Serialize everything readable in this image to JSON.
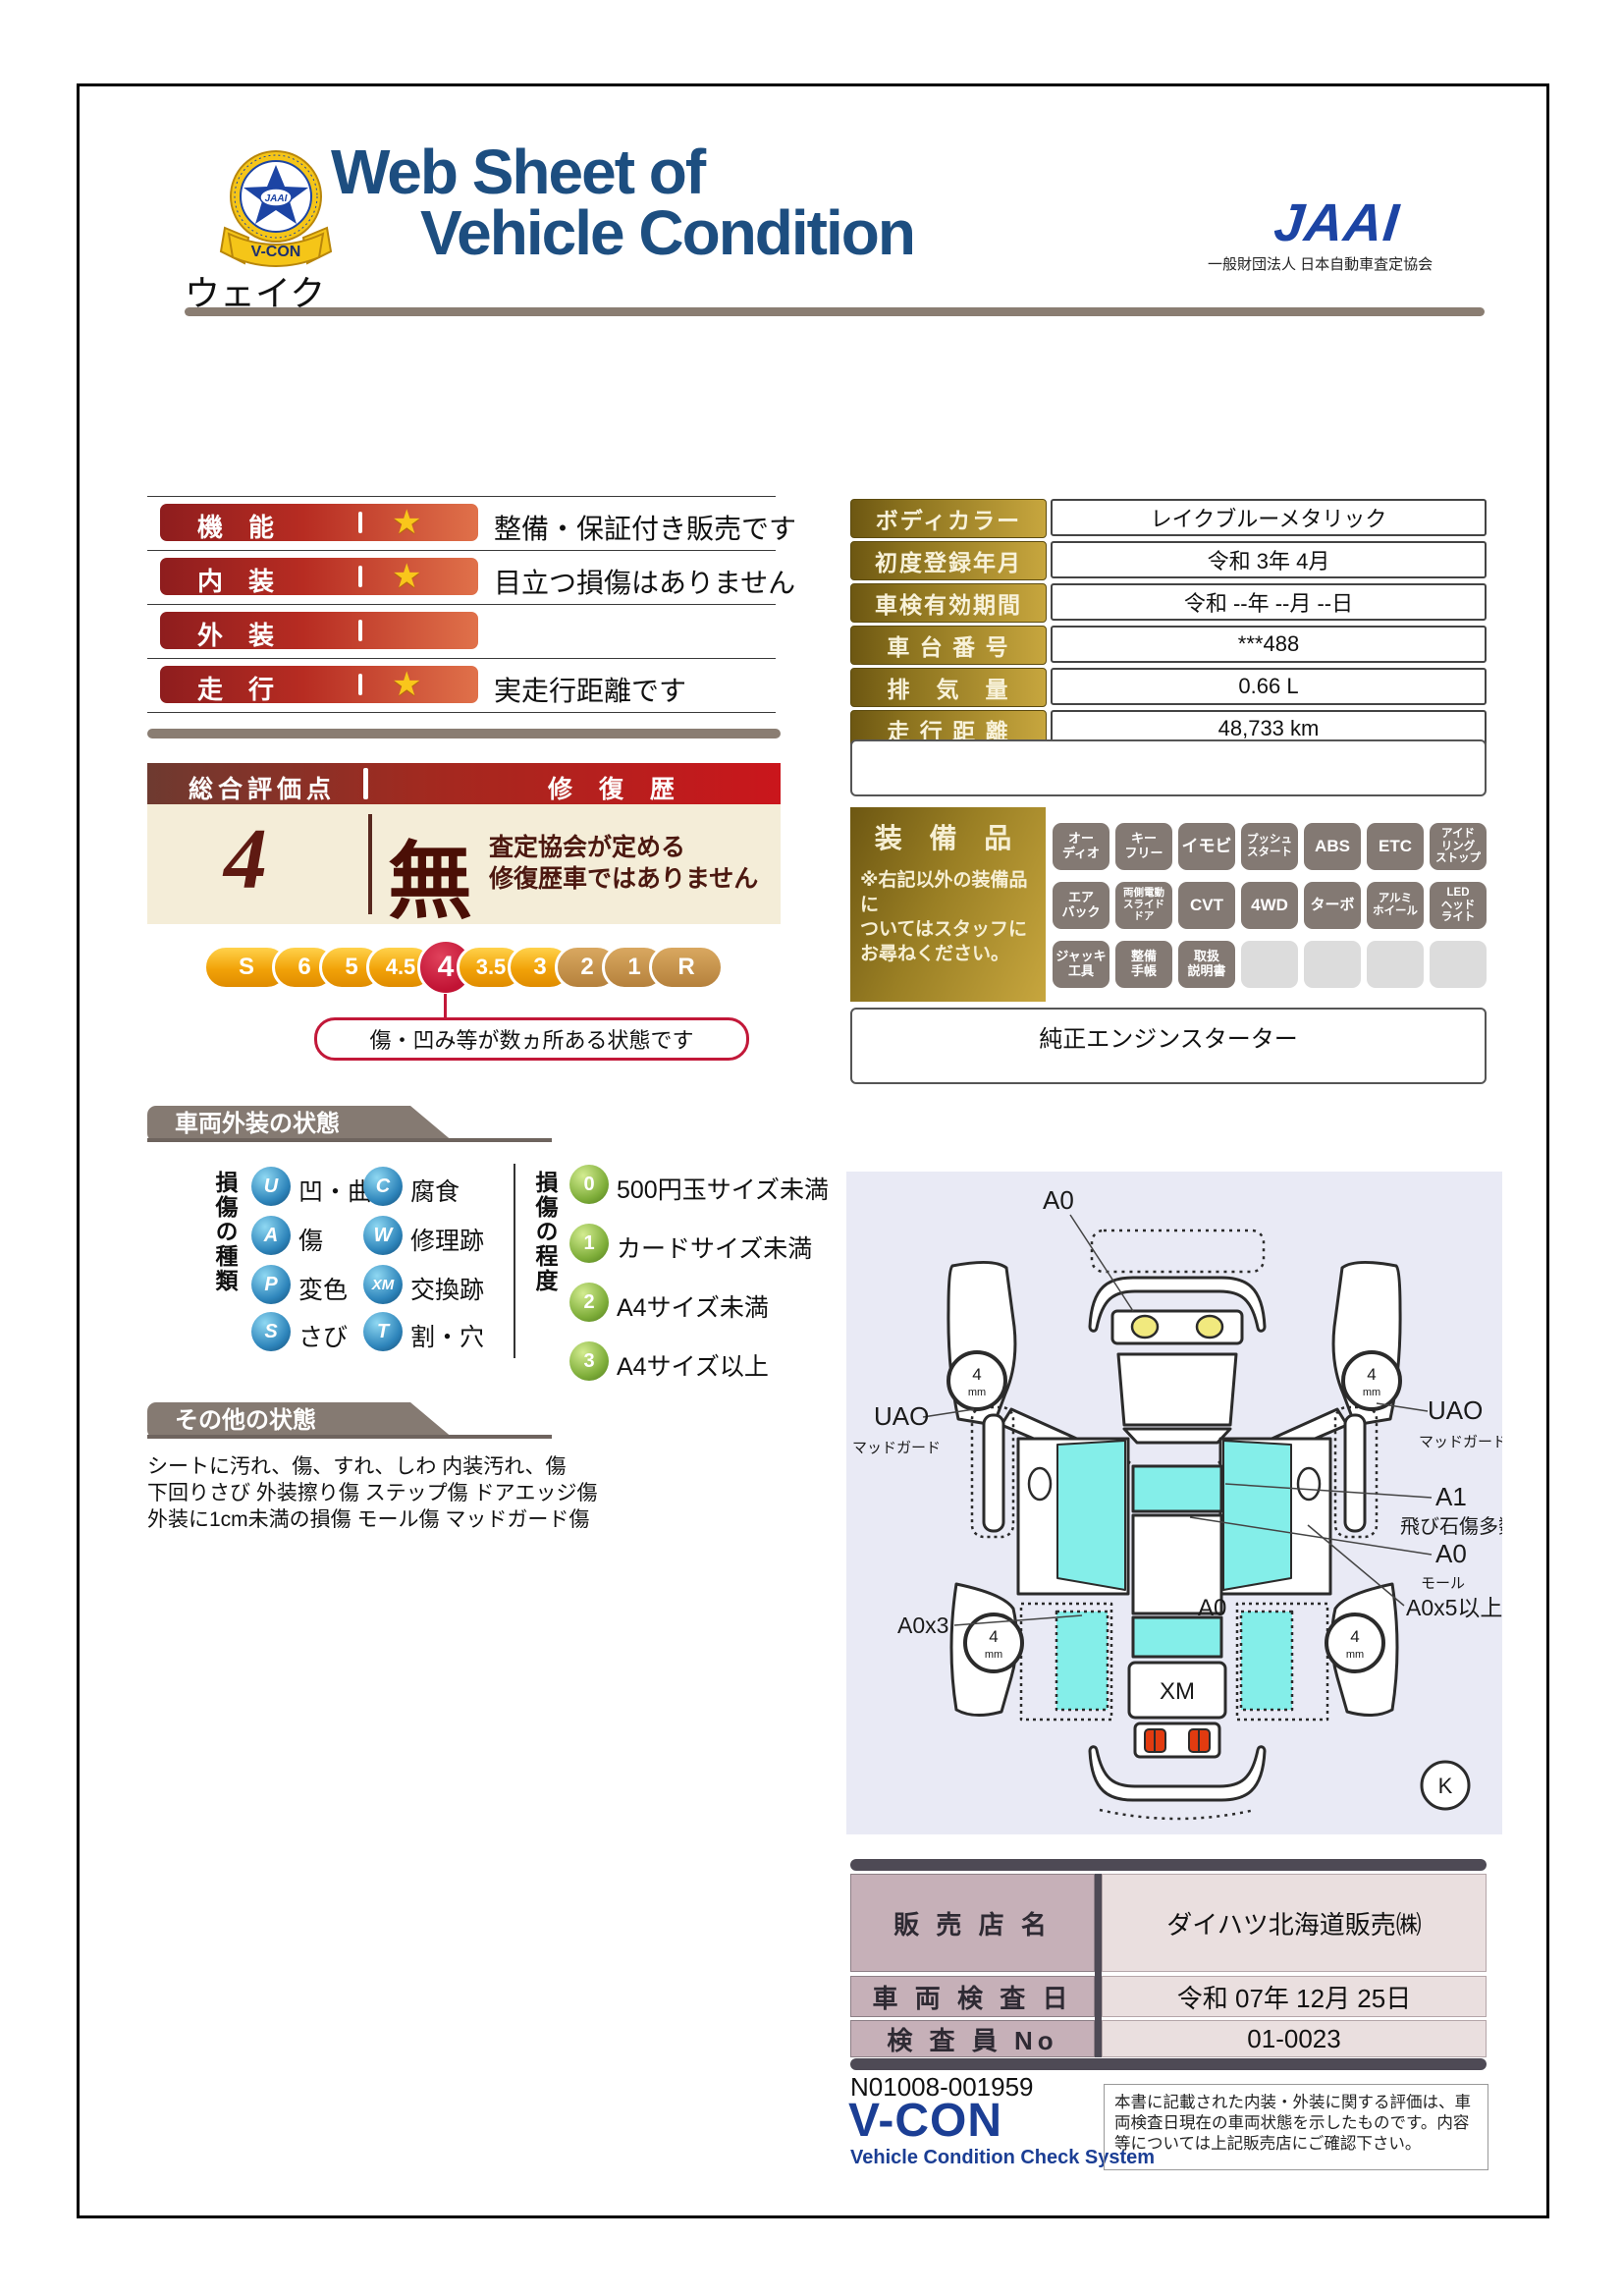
{
  "header": {
    "title_line1": "Web Sheet of",
    "title_line2": "Vehicle Condition",
    "badge_text": "V-CON",
    "badge_star_text": "JAAI",
    "jaai_logo": "JAAI",
    "jaai_subtitle": "一般財団法人 日本自動車査定協会"
  },
  "vehicle_name": "ウェイク",
  "ratings": [
    {
      "label": "機　能",
      "comment": "整備・保証付き販売です"
    },
    {
      "label": "内　装",
      "comment": "目立つ損傷はありません"
    },
    {
      "label": "外　装",
      "comment": ""
    },
    {
      "label": "走　行",
      "comment": "実走行距離です"
    }
  ],
  "overall": {
    "header_left": "総合評価点",
    "header_right": "修 復 歴",
    "score": "4",
    "repair_char": "無",
    "repair_line1": "査定協会が定める",
    "repair_line2": "修復歴車ではありません",
    "scale": [
      "S",
      "6",
      "5",
      "4.5",
      "4",
      "3.5",
      "3",
      "2",
      "1",
      "R"
    ],
    "bubble": "傷・凹み等が数ヵ所ある状態です"
  },
  "details": [
    {
      "label": "ボディカラー",
      "value": "レイクブルーメタリック"
    },
    {
      "label": "初度登録年月",
      "value": "令和 3年 4月"
    },
    {
      "label": "車検有効期間",
      "value": "令和 --年 --月 --日"
    },
    {
      "label": "車 台 番 号",
      "value": "***488"
    },
    {
      "label": "排　気　量",
      "value": "0.66 L"
    },
    {
      "label": "走 行 距 離",
      "value": "48,733 km"
    }
  ],
  "equipment": {
    "title": "装 備 品",
    "note": "※右記以外の装備品に\nついてはスタッフに\nお尋ねください。",
    "badges": [
      "オー\nディオ",
      "キー\nフリー",
      "イモビ",
      "プッシュ\nスタート",
      "ABS",
      "ETC",
      "アイド\nリング\nストップ",
      "エア\nバック",
      "両側電動\nスライド\nドア",
      "CVT",
      "4WD",
      "ターボ",
      "アルミ\nホイール",
      "LED\nヘッド\nライト",
      "ジャッキ\n工具",
      "整備\n手帳",
      "取扱\n説明書"
    ],
    "starter": "純正エンジンスターター"
  },
  "exterior": {
    "header": "車両外装の状態",
    "type_title": "損傷の種類",
    "types": [
      {
        "code": "U",
        "label": "凹・曲"
      },
      {
        "code": "C",
        "label": "腐食"
      },
      {
        "code": "A",
        "label": "傷"
      },
      {
        "code": "W",
        "label": "修理跡"
      },
      {
        "code": "P",
        "label": "変色"
      },
      {
        "code": "XM",
        "label": "交換跡"
      },
      {
        "code": "S",
        "label": "さび"
      },
      {
        "code": "T",
        "label": "割・穴"
      }
    ],
    "degree_title": "損傷の程度",
    "degrees": [
      {
        "code": "0",
        "label": "500円玉サイズ未満"
      },
      {
        "code": "1",
        "label": "カードサイズ未満"
      },
      {
        "code": "2",
        "label": "A4サイズ未満"
      },
      {
        "code": "3",
        "label": "A4サイズ以上"
      }
    ]
  },
  "other": {
    "header": "その他の状態",
    "line1": "シートに汚れ、傷、すれ、しわ 内装汚れ、傷",
    "line2": "下回りさび 外装擦り傷 ステップ傷 ドアエッジ傷",
    "line3": "外装に1cm未満の損傷 モール傷 マッドガード傷"
  },
  "diagram": {
    "a0_top": "A0",
    "uao": "UAO",
    "mudguard": "マッドガード",
    "a1": "A1",
    "stone": "飛び石傷多数",
    "a0_right": "A0",
    "mole": "モール",
    "a0x5": "A0x5以上",
    "a0x3": "A0x3",
    "a0_center": "A0",
    "xm": "XM",
    "k": "K",
    "tread": "4",
    "tread_unit": "mm"
  },
  "dealer": [
    {
      "label": "販 売 店 名",
      "value": "ダイハツ北海道販売㈱"
    },
    {
      "label": "車 両 検 査 日",
      "value": "令和 07年 12月 25日"
    },
    {
      "label": "検 査 員 No",
      "value": "01-0023"
    }
  ],
  "footer": {
    "number": "N01008-001959",
    "vcon": "V-CON",
    "vcon_sub": "Vehicle Condition Check System",
    "disclaimer": "本書に記載された内装・外装に関する評価は、車両検査日現在の車両状態を示したものです。内容等については上記販売店にご確認下さい。"
  }
}
